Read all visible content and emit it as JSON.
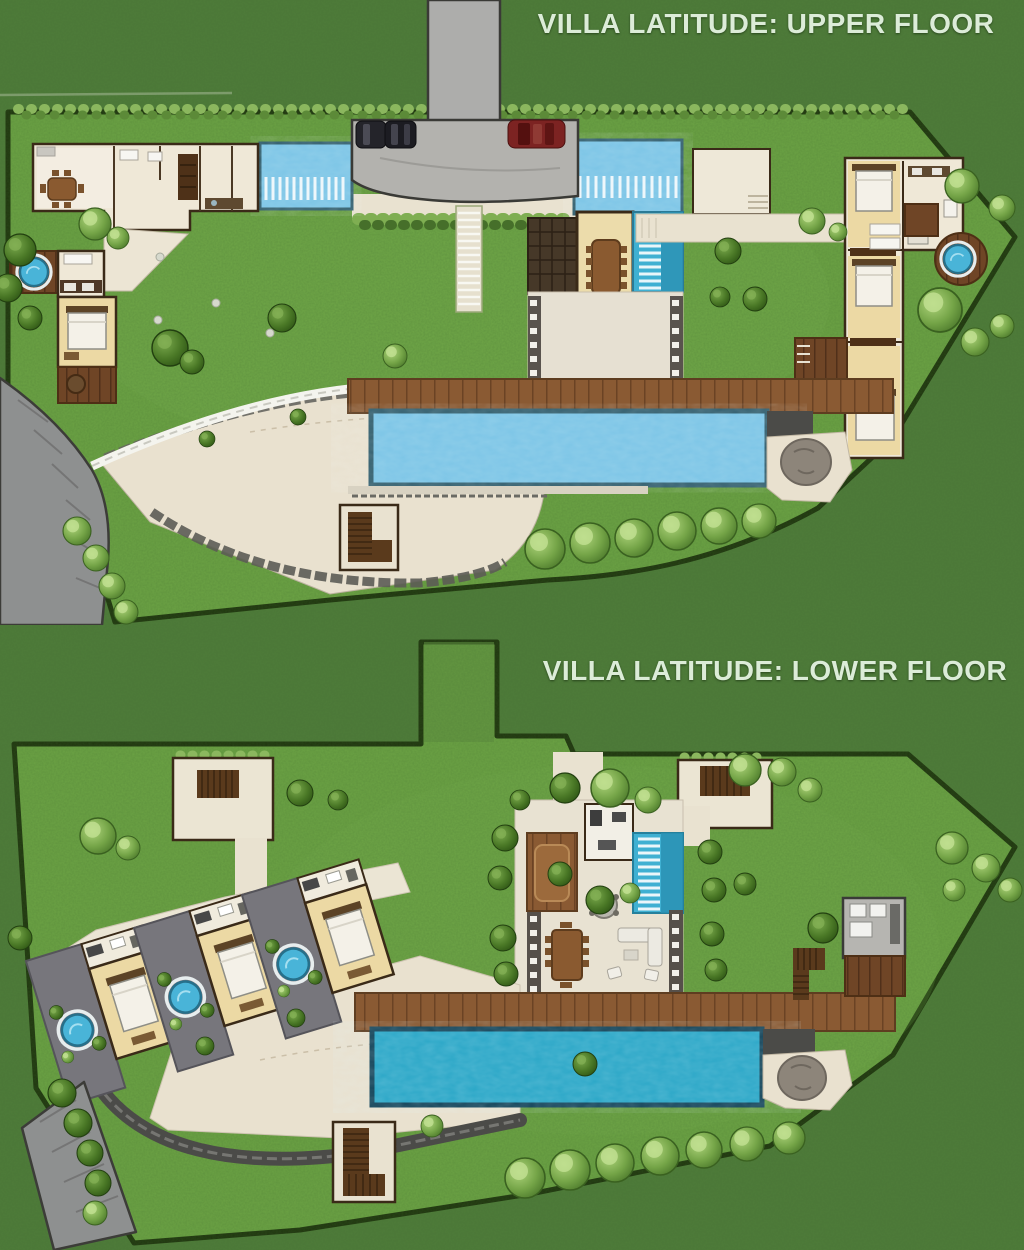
{
  "canvas": {
    "width": 1024,
    "height": 1250
  },
  "plans": [
    {
      "id": "upper",
      "title": "VILLA LATITUDE: UPPER FLOOR"
    },
    {
      "id": "lower",
      "title": "VILLA LATITUDE: LOWER FLOOR"
    }
  ],
  "palette": {
    "grass_outer": "#4f7c3a",
    "grass_inner": "#6ca344",
    "boundary": "#20360f",
    "hedge_light": "#8bb75e",
    "hedge_dark": "#5c8a38",
    "driveway_gray": "#b3b2ae",
    "road_gray": "#8e9090",
    "car_dark": "#24242a",
    "car_red": "#7c2322",
    "pool_upper": "#7cc5e6",
    "pool_lower": "#2ba7c7",
    "water_feature": "#3fb0d2",
    "plunge_tub": "#49b4d8",
    "deck_wood": "#8a5a33",
    "deck_wood_dark": "#6f4526",
    "floor_cream": "#efe8d7",
    "room_tan": "#ecd9a4",
    "wall_dark": "#3a2a18",
    "terrace_beige": "#e9e1cf",
    "stone_dark": "#4b4b48",
    "patio_gray": "#77767c",
    "boulder_gray": "#8d857a",
    "title_text": "#dcecd8"
  },
  "features": {
    "upper": [
      "driveway-with-parked-cars",
      "entrance-ponds-with-slat-bridges",
      "kitchen-dining-wing",
      "dining-pavilion-with-water-feature",
      "entry-court-and-walkway",
      "guest-suite-with-plunge-tub",
      "bedroom-wing-with-spa-deck",
      "timber-sun-deck",
      "lap-pool",
      "curved-garden-terrace",
      "access-road",
      "garden-staircase"
    ],
    "lower": [
      "garden-entry-corridor",
      "garden-staircases",
      "living-court-with-water-wall",
      "three-bedroom-suites-with-plunge-tubs",
      "garden-terrace",
      "timber-sun-deck",
      "lap-pool",
      "utility-room",
      "access-road",
      "boulder-patio"
    ]
  },
  "counts": {
    "parked_cars_dark": 2,
    "parked_cars_red": 1,
    "bedroom_suites_lower_wing": 3,
    "lap_pools": 2
  }
}
